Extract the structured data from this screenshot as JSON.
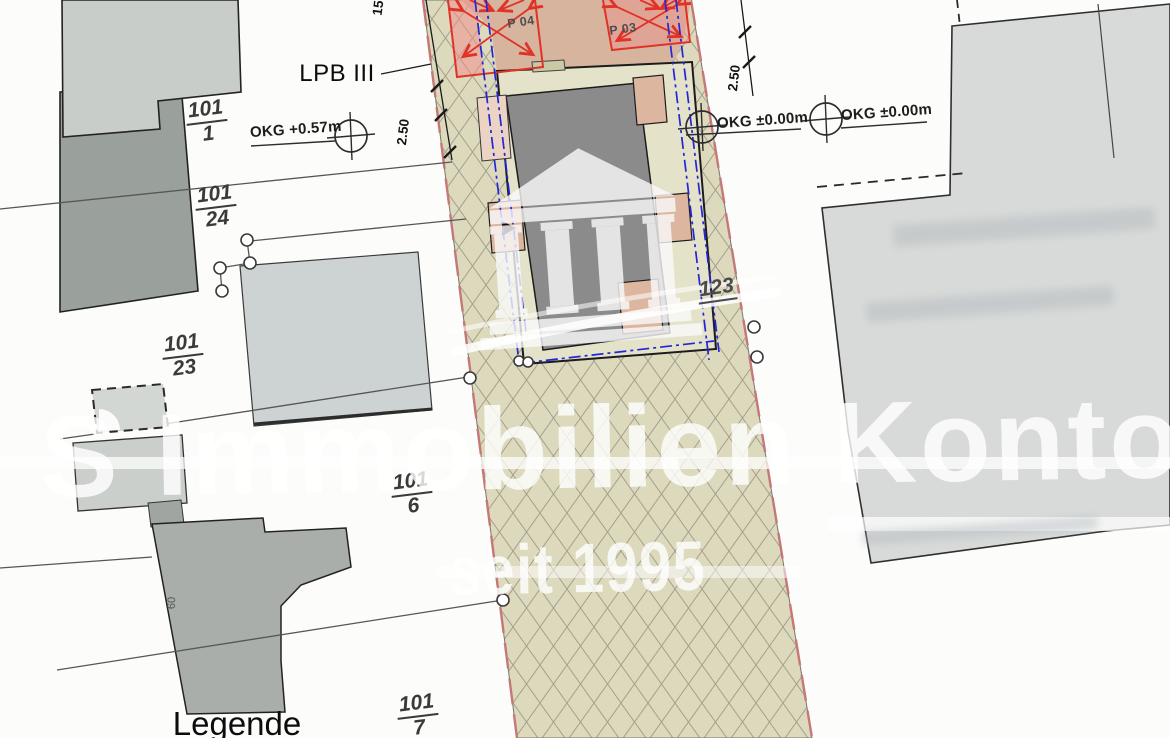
{
  "plan": {
    "area_label": "LPB III",
    "legend_title": "Legende",
    "elevation_marks": {
      "left": "OKG +0.57m",
      "middle": "OKG ±0.00m",
      "right": "OKG ±0.00m"
    },
    "parcels": [
      {
        "num": "101",
        "den": "1"
      },
      {
        "num": "101",
        "den": "24"
      },
      {
        "num": "101",
        "den": "23"
      },
      {
        "num": "101",
        "den": "6"
      },
      {
        "num": "101",
        "den": "7"
      }
    ],
    "site_parcel_number": "123",
    "parking_stalls": [
      "P 04",
      "P 03"
    ],
    "dimensions": {
      "top": "15",
      "left": "2.50",
      "right": "2.50",
      "house_depth": "60"
    },
    "watermark": {
      "line1": "S Immobilien Kontor",
      "line2": "seit 1995"
    },
    "colors": {
      "strip_beige": "#ddd9bd",
      "hatch_line": "#a39f8d",
      "parking_tan": "#d6b49e",
      "stall_red": "#e03227",
      "stall_pink": "#f2a0a0",
      "boundary_blue": "#2326d6",
      "plot_beige": "#e5e2ca",
      "building_dark": "#8b8b8b",
      "peach": "#dcb69e",
      "pink_edge": "#c47878",
      "watermark_white": "#ffffff"
    }
  }
}
